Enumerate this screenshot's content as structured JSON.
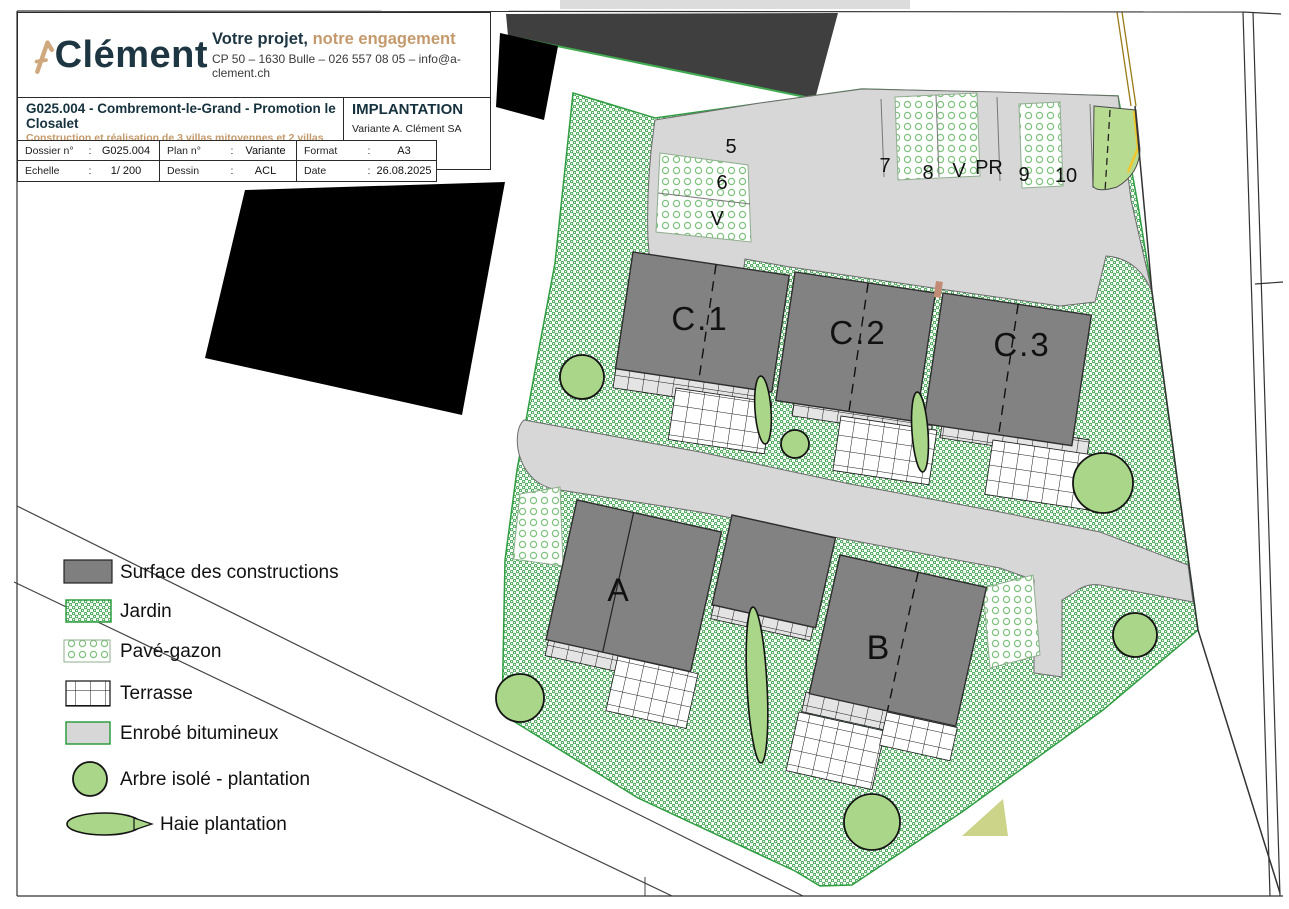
{
  "colors": {
    "accent_tan": "#c49a6c",
    "dark_teal": "#1d3642",
    "plan_green": "#35a047",
    "building_gray": "#828282",
    "asphalt_gray": "#d7d7d7",
    "tree_green": "#a9d688",
    "yellow_boundary": "#f0c829",
    "dark_building": "#3f3f3f"
  },
  "header": {
    "logo_text": "Clément",
    "tagline_dark": "Votre projet,",
    "tagline_accent": "notre engagement",
    "contact": "CP 50 – 1630 Bulle – 026 557 08 05 – info@a-clement.ch",
    "title": "G025.004 - Combremont-le-Grand - Promotion le Closalet",
    "subtitle": "Construction et réalisation de 3 villas mitoyennes et 2 villas individuelles",
    "ref_line": "1535 Combremont-le-Grand - Article 2025",
    "plan_type": "IMPLANTATION",
    "variant": "Variante A. Clément SA",
    "colon": ":",
    "table": {
      "rows": [
        [
          {
            "label": "Dossier n°",
            "value": "G025.004"
          },
          {
            "label": "Plan n°",
            "value": "Variante"
          },
          {
            "label": "Format",
            "value": "A3"
          }
        ],
        [
          {
            "label": "Echelle",
            "value": "1/ 200"
          },
          {
            "label": "Dessin",
            "value": "ACL"
          },
          {
            "label": "Date",
            "value": "26.08.2025"
          }
        ]
      ]
    }
  },
  "legend": {
    "items": [
      {
        "label": "Surface des constructions",
        "swatch": "building-gray"
      },
      {
        "label": "Jardin",
        "swatch": "garden-hatch"
      },
      {
        "label": "Pavé-gazon",
        "swatch": "grass-paver"
      },
      {
        "label": "Terrasse",
        "swatch": "terrace-grid"
      },
      {
        "label": "Enrobé bitumineux",
        "swatch": "asphalt"
      },
      {
        "label": "Arbre isolé - plantation",
        "swatch": "tree"
      },
      {
        "label": "Haie plantation",
        "swatch": "hedge"
      }
    ]
  },
  "plan": {
    "villas": {
      "c1": "C.1",
      "c2": "C.2",
      "c3": "C.3",
      "a": "A",
      "b": "B"
    },
    "parking": {
      "p5": "5",
      "p6": "6",
      "v_left": "V",
      "p7": "7",
      "p8": "8",
      "v_top": "V",
      "pr": "PR",
      "p9": "9",
      "p10": "10"
    }
  }
}
